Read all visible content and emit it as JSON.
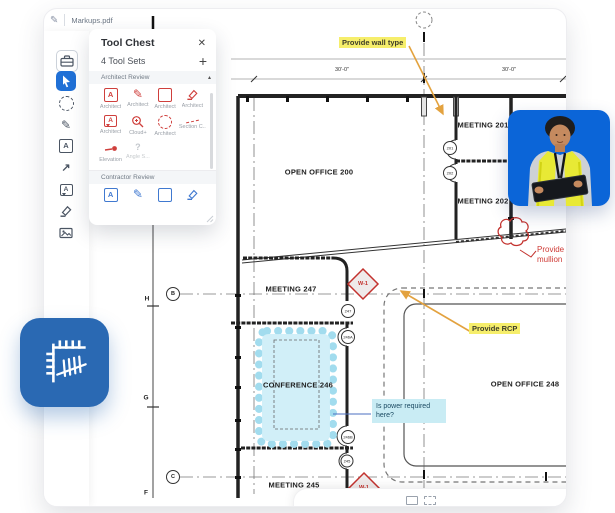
{
  "app": {
    "tab_title": "Markups.pdf"
  },
  "glyphs": {
    "a": "A",
    "question": "?",
    "plus": "+",
    "close": "✕",
    "caret": "▴",
    "pen": "✎",
    "arrow_ne": "↗"
  },
  "left_toolbar": {
    "items": [
      "tool-chest",
      "select-cursor",
      "lasso",
      "pen",
      "text-box",
      "arrow",
      "callout",
      "highlighter",
      "image"
    ]
  },
  "tool_chest": {
    "title": "Tool Chest",
    "subtitle": "4 Tool Sets",
    "sections": [
      {
        "name": "Architect Review",
        "tools": [
          {
            "label": "Architect",
            "icon": "text-box"
          },
          {
            "label": "Architect",
            "icon": "pen"
          },
          {
            "label": "Architect",
            "icon": "rectangle"
          },
          {
            "label": "Architect",
            "icon": "highlighter"
          },
          {
            "label": "Architect",
            "icon": "callout"
          },
          {
            "label": "Cloud+",
            "icon": "magnifier-plus"
          },
          {
            "label": "Architect",
            "icon": "cloud"
          },
          {
            "label": "Section C...",
            "icon": "section-line"
          },
          {
            "label": "Elevation",
            "icon": "elevation-marker"
          },
          {
            "label": "Angle S...",
            "icon": "unknown"
          }
        ]
      },
      {
        "name": "Contractor Review",
        "tools": [
          {
            "icon": "text-box"
          },
          {
            "icon": "pen"
          },
          {
            "icon": "rectangle"
          },
          {
            "icon": "highlighter"
          }
        ]
      }
    ]
  },
  "plan": {
    "rooms": [
      {
        "name": "OPEN OFFICE  200"
      },
      {
        "name": "MEETING  201"
      },
      {
        "name": "MEETING  202"
      },
      {
        "name": "MEETING  247"
      },
      {
        "name": "CONFERENCE  246"
      },
      {
        "name": "MEETING  245"
      },
      {
        "name": "OPEN OFFICE  248"
      }
    ],
    "dimensions": [
      "30'-0\"",
      "30'-0\""
    ],
    "grid_bubbles": [
      "B",
      "C"
    ],
    "ruler_letters": [
      "H",
      "G",
      "F"
    ],
    "door_tags": [
      "201",
      "202",
      "247",
      "246A",
      "246B",
      "245"
    ],
    "wall_tags": [
      "W-1",
      "W-1"
    ],
    "annotations": {
      "wall_type": "Provide wall type",
      "rcp": "Provide RCP",
      "mullion_line1": "Provide",
      "mullion_line2": "mullion",
      "power_line1": "Is power required",
      "power_line2": "here?"
    }
  },
  "colors": {
    "markup_red": "#cf3b36",
    "highlight_yellow": "#f6ee6b",
    "highlight_cyan": "#c9ecf4",
    "arrow_orange": "#e3a23f",
    "accent_blue": "#2070d6",
    "app_icon_blue": "#2a69b3",
    "photo_background": "#0b65d8"
  }
}
